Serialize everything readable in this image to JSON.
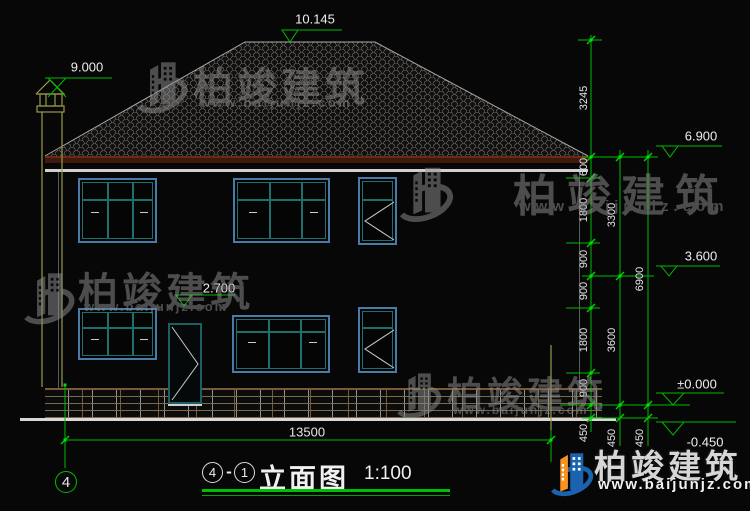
{
  "drawing": {
    "axis_bubble": "4",
    "title": {
      "axis_start": "4",
      "separator": "-",
      "axis_end": "1",
      "name": "立面图",
      "scale": "1:100"
    },
    "elevations": {
      "ridge": "10.145",
      "chimney": "9.000",
      "eave": "6.900",
      "floor2": "3.600",
      "door_head": "2.700",
      "ground": "±0.000",
      "outdoor": "-0.450"
    },
    "dimensions": {
      "right_chain_inner": [
        "3245",
        "600",
        "1800",
        "900",
        "900",
        "1800",
        "900",
        "450"
      ],
      "right_chain_mid": [
        "3300",
        "3600",
        "450"
      ],
      "right_chain_outer": [
        "6900",
        "450"
      ],
      "bottom_overall": "13500"
    }
  },
  "watermark": {
    "name": "柏竣建筑",
    "url": "www.baijunjz.com"
  },
  "brand": {
    "name": "柏竣建筑",
    "url": "www.baijunjz.com"
  },
  "colors": {
    "dimension_green": "#00b900",
    "bright_green": "#00e000",
    "brand_blue": "#1b63ae",
    "brand_orange": "#f6921e",
    "window_frame_blue": "#4a7aa8",
    "window_mullion_teal": "#1f6f6f",
    "chimney_yellow": "#9a9a4a"
  }
}
